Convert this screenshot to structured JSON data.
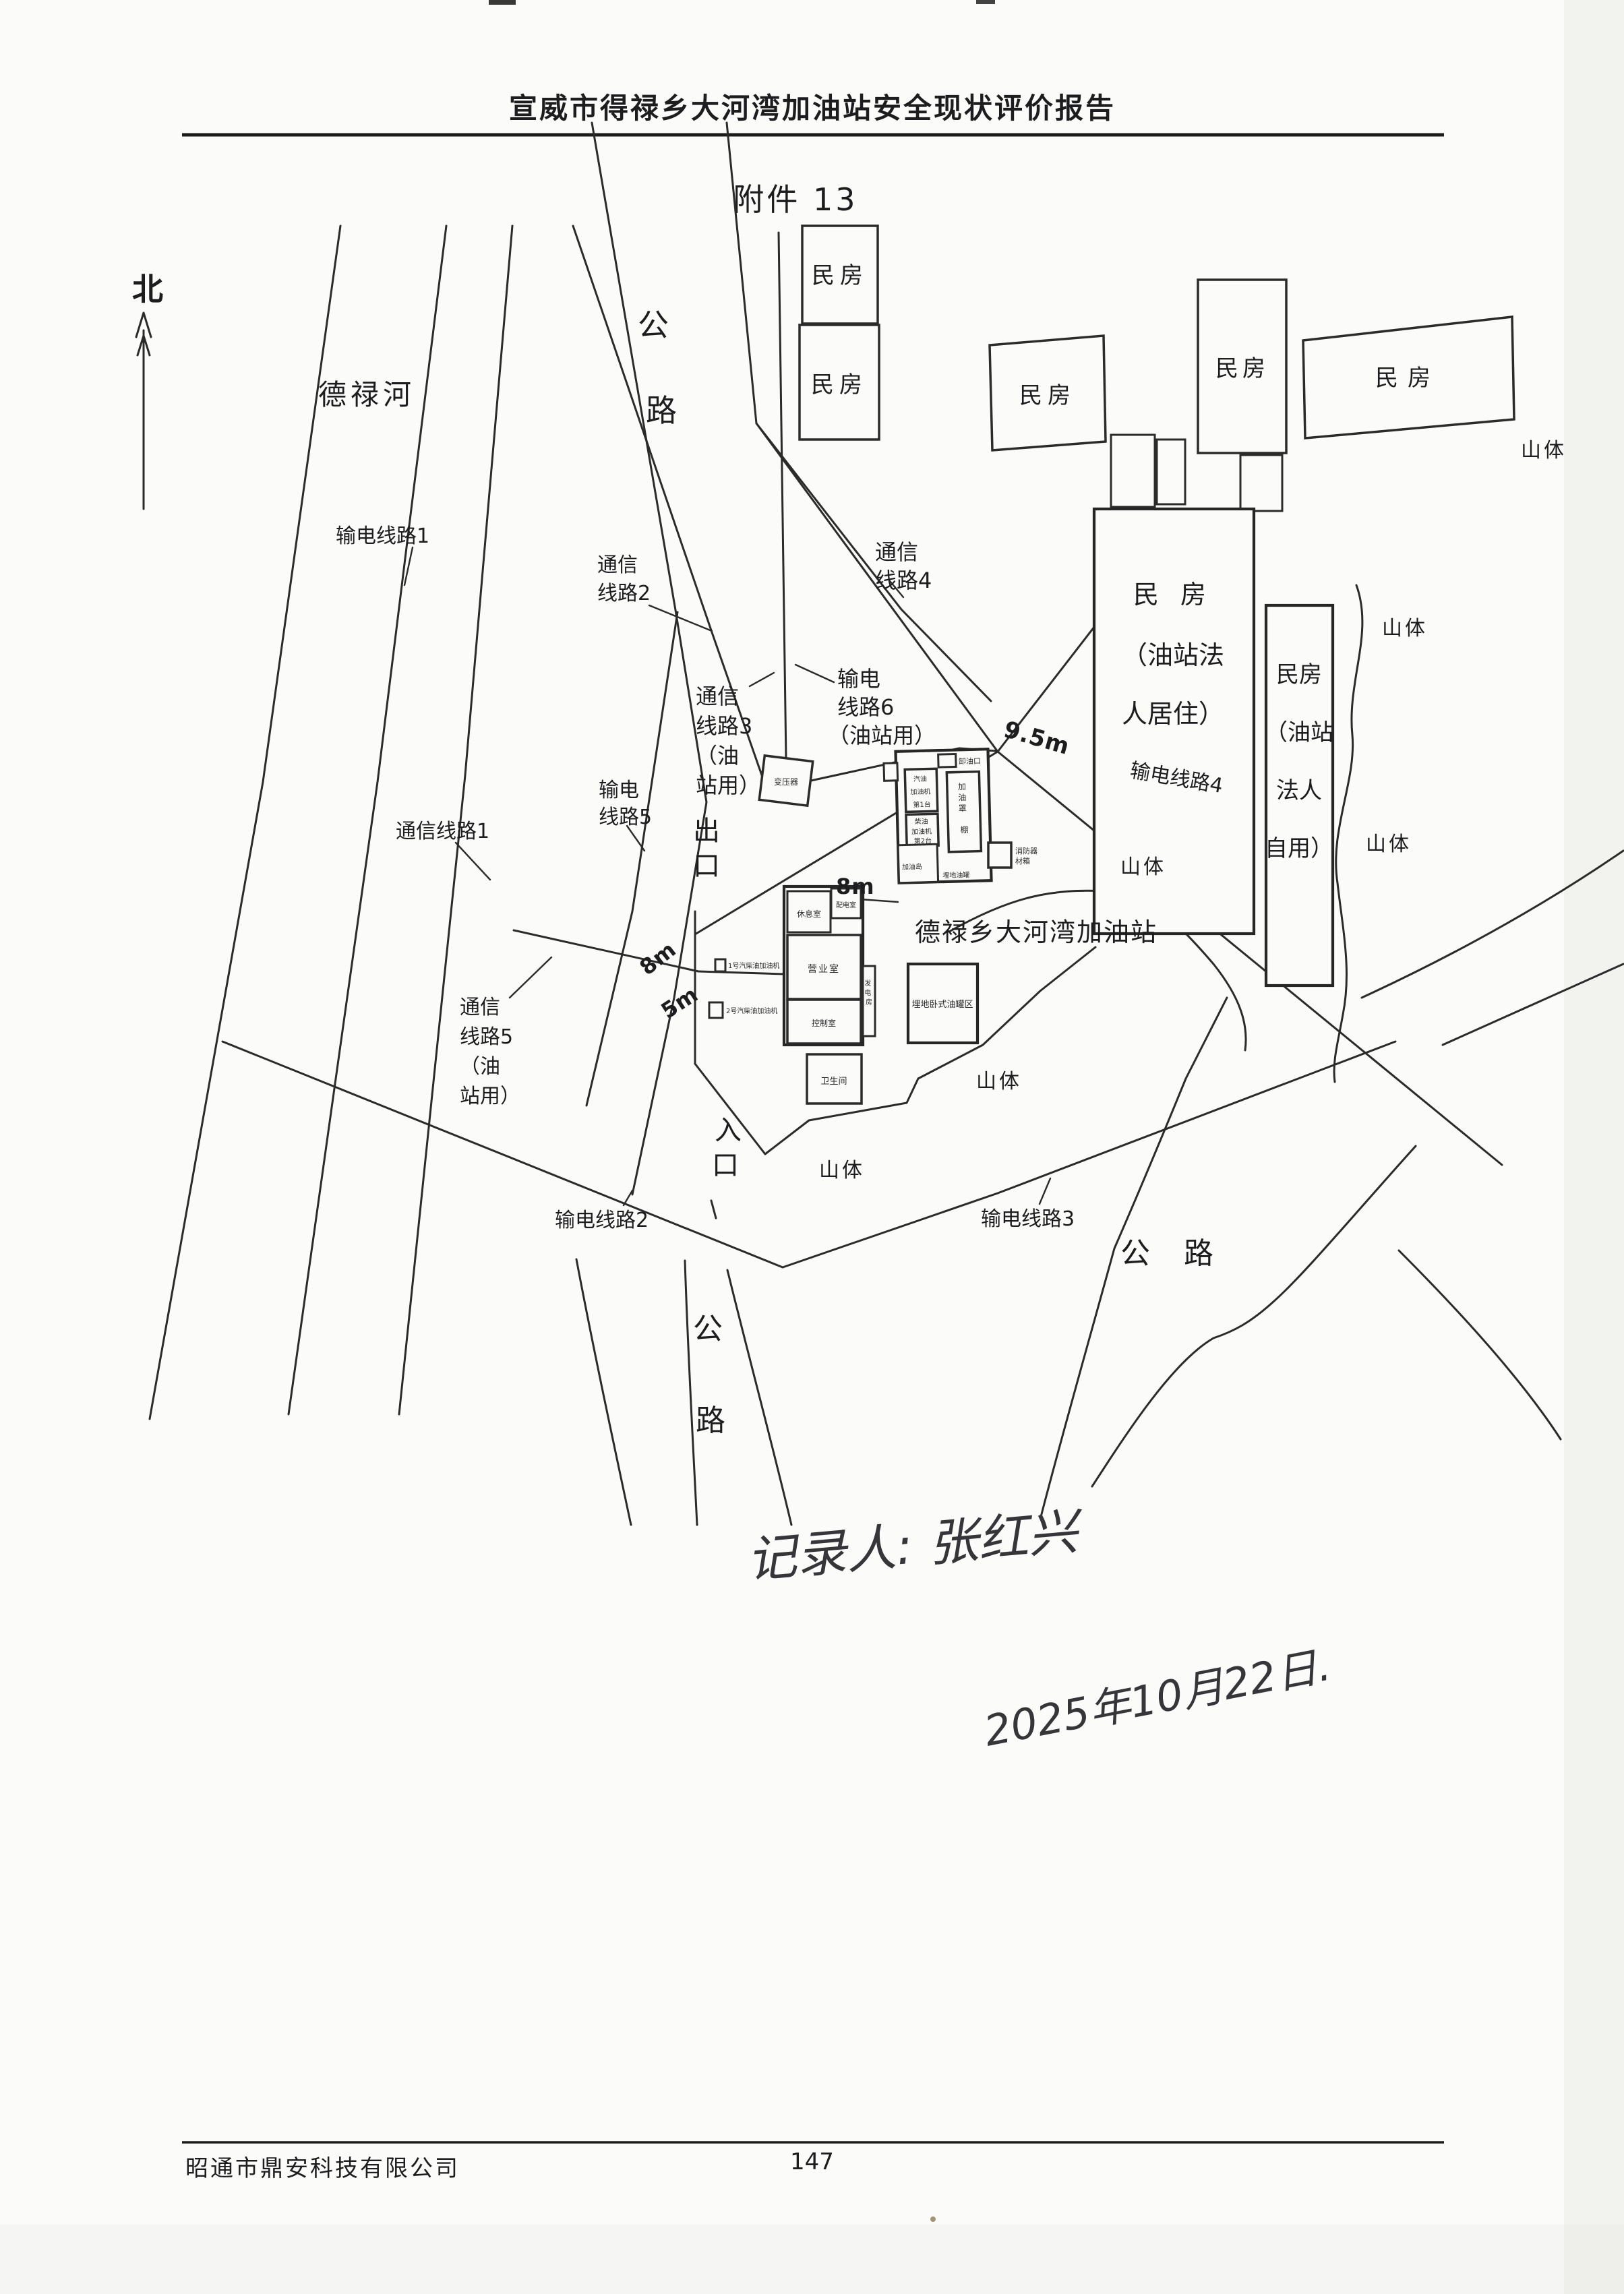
{
  "header": {
    "report_title": "宣威市得禄乡大河湾加油站安全现状评价报告",
    "attachment_label": "附件 13"
  },
  "footer": {
    "company": "昭通市鼎安科技有限公司",
    "page_number": "147"
  },
  "compass": {
    "north_label": "北"
  },
  "handwriting": {
    "recorder_line": "记录人: 张红兴",
    "date_line": "2025年10月22日."
  },
  "map": {
    "river_label": "德禄河",
    "station_label": "德禄乡大河湾加油站",
    "road_top": [
      "公",
      "路"
    ],
    "road_bottom": [
      "公",
      "路"
    ],
    "road_right": "公  路",
    "gate_exit": [
      "出",
      "口"
    ],
    "gate_entrance": [
      "入",
      "口"
    ],
    "houses": [
      "民房",
      "民房",
      "民房",
      "民房",
      "民房"
    ],
    "house_owner_residence": [
      "民 房",
      "（油站法",
      "人居住）"
    ],
    "house_owner_private": [
      "民房",
      "（油站",
      "法人",
      "自用）"
    ],
    "mountains": [
      "山体",
      "山体",
      "山体",
      "山体",
      "山体",
      "山体"
    ],
    "dimensions": {
      "to_house": "9.5m",
      "canopy_west": "8m",
      "boundary_west": "8m",
      "south_gap": "5m"
    },
    "power_lines": {
      "p1": "输电线路1",
      "p2": "输电线路2",
      "p3": "输电线路3",
      "p4": "输电线路4",
      "p5": [
        "输电",
        "线路5"
      ],
      "p6": [
        "输电",
        "线路6",
        "（油站用）"
      ]
    },
    "telecom_lines": {
      "t1": "通信线路1",
      "t2": [
        "通信",
        "线路2"
      ],
      "t3": [
        "通信",
        "线路3",
        "（油",
        "站用）"
      ],
      "t4": [
        "通信",
        "线路4"
      ],
      "t5": [
        "通信",
        "线路5",
        "（油",
        "站用）"
      ]
    }
  },
  "station": {
    "transformer": "变压器",
    "unloading_point": "卸油口",
    "canopy_vertical": [
      "加",
      "油",
      "罩",
      "棚"
    ],
    "dispenser_box_a": [
      "汽油",
      "加油机",
      "第1台"
    ],
    "dispenser_box_b": [
      "柴油",
      "加油机",
      "第2台"
    ],
    "island_label": "加油岛",
    "buried_tank_label": "埋地油罐",
    "tank_area_label": "埋地卧式油罐区",
    "fire_box": [
      "消防器",
      "材箱"
    ],
    "rooms": {
      "rest": "休息室",
      "distribution": "配电室",
      "business": "营业室",
      "control": "控制室",
      "generator": [
        "发",
        "电",
        "房"
      ],
      "toilet": "卫生间"
    },
    "dispenser1_label": "1号汽柴油加油机",
    "dispenser2_label": "2号汽柴油加油机"
  }
}
